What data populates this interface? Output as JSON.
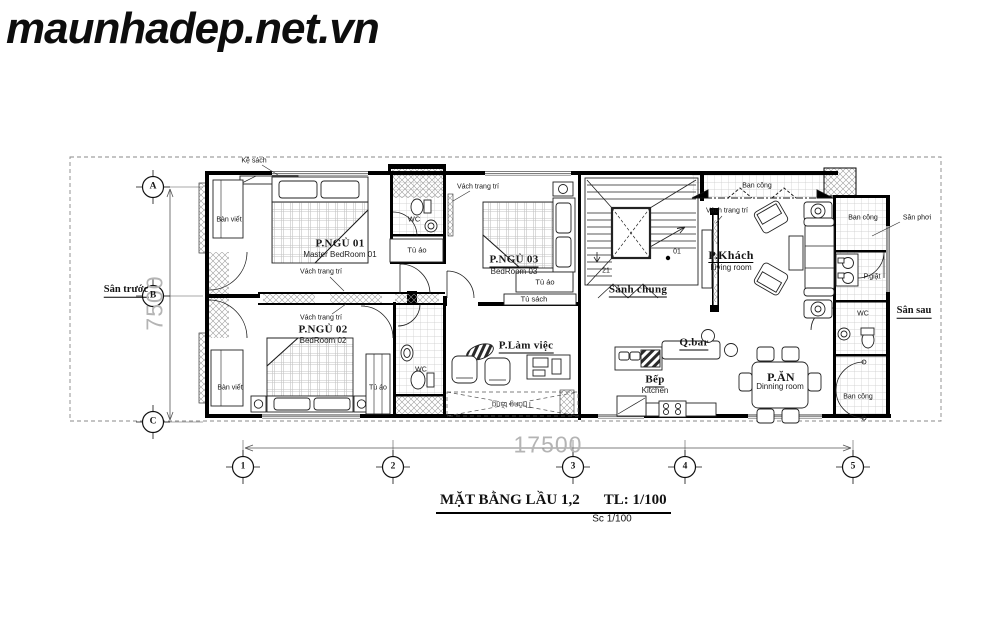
{
  "watermark": "maunhadep.net.vn",
  "title_block": {
    "main": "MẶT BẰNG LẦU 1,2",
    "scale": "TL: 1/100",
    "scale_small": "Sc 1/100"
  },
  "dimensions": {
    "horizontal": "17500",
    "vertical": "7500"
  },
  "grid_markers": {
    "rows": [
      "A",
      "B",
      "C"
    ],
    "columns": [
      "1",
      "2",
      "3",
      "4",
      "5"
    ]
  },
  "stair_steps": {
    "start": "21",
    "end": "01"
  },
  "rooms": {
    "bedroom1": {
      "name": "P.NGỦ 01",
      "en": "Master BedRoom 01"
    },
    "bedroom2": {
      "name": "P.NGỦ 02",
      "en": "BedRoom 02"
    },
    "bedroom3": {
      "name": "P.NGỦ 03",
      "en": "BedRoom 03"
    },
    "hall": {
      "name": "Sảnh chung"
    },
    "living": {
      "name": "P.Khách",
      "en": "Living room"
    },
    "study": {
      "name": "P.Làm việc"
    },
    "kitchen": {
      "name": "Bếp",
      "en": "Kitchen"
    },
    "dining": {
      "name": "P.ĂN",
      "en": "Dinning room"
    },
    "bar": {
      "name": "Q.bar"
    },
    "laundry": {
      "name": "P.giặt"
    },
    "void": {
      "name": "Thông tầng"
    },
    "front_yard": {
      "name": "Sân trước"
    },
    "back_yard": {
      "name": "Sân sau"
    },
    "drying_yard": {
      "name": "Sân phơi"
    }
  },
  "fixtures": {
    "wc": "WC",
    "wardrobe": "Tủ áo",
    "wall_shelf": "Kệ sách",
    "bookcase": "Tủ sách",
    "desk": "Bàn viết",
    "decor_wall": "Vách trang trí",
    "balcony": "Ban công"
  },
  "colors": {
    "wall": "#000000",
    "dimension_text": "#b4b4b4",
    "tile_line": "#c9c9c9",
    "boundary_dash": "#888888"
  }
}
